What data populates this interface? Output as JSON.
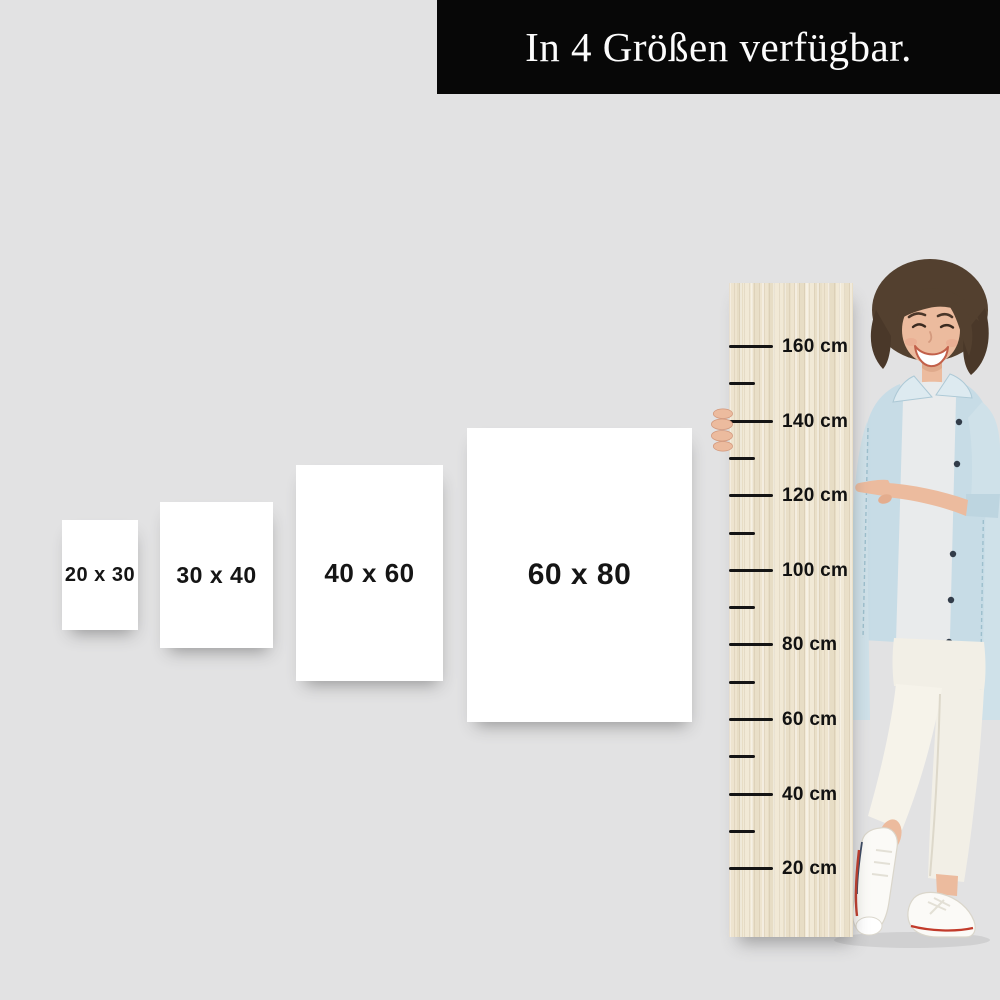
{
  "title_banner": {
    "text": "In 4 Größen verfügbar.",
    "background": "#070707",
    "color": "#fcfcfc"
  },
  "canvas": {
    "background": "#e2e2e3"
  },
  "posters": [
    {
      "label": "20 x 30"
    },
    {
      "label": "30 x 40"
    },
    {
      "label": "40 x 60"
    },
    {
      "label": "60 x 80"
    }
  ],
  "ruler": {
    "material": "wood",
    "wood_base_color": "#ebe1cb",
    "tick_color": "#141414",
    "label_color": "#111111",
    "min_label": "20 cm",
    "max_label": "160 cm",
    "minor_step_cm": 10,
    "labeled_step_cm": 20,
    "ticks": [
      {
        "type": "long",
        "label": "160 cm"
      },
      {
        "type": "short",
        "label": ""
      },
      {
        "type": "long",
        "label": "140 cm"
      },
      {
        "type": "short",
        "label": ""
      },
      {
        "type": "long",
        "label": "120 cm"
      },
      {
        "type": "short",
        "label": ""
      },
      {
        "type": "long",
        "label": "100 cm"
      },
      {
        "type": "short",
        "label": ""
      },
      {
        "type": "long",
        "label": "80 cm"
      },
      {
        "type": "short",
        "label": ""
      },
      {
        "type": "long",
        "label": "60 cm"
      },
      {
        "type": "short",
        "label": ""
      },
      {
        "type": "long",
        "label": "40 cm"
      },
      {
        "type": "short",
        "label": ""
      },
      {
        "type": "long",
        "label": "20 cm"
      }
    ]
  },
  "person": {
    "pose": "smiling woman with short brown hair pointing at the 120 cm mark",
    "hair_color": "#53402f",
    "skin_color": "#ecbb9e",
    "jacket_color": "#cfe1e9",
    "shirt_color": "#e9ebec",
    "pants_color": "#f2efe6",
    "shoe_color": "#fbfaf7",
    "shoe_stripe_color": "#c23b2b"
  }
}
